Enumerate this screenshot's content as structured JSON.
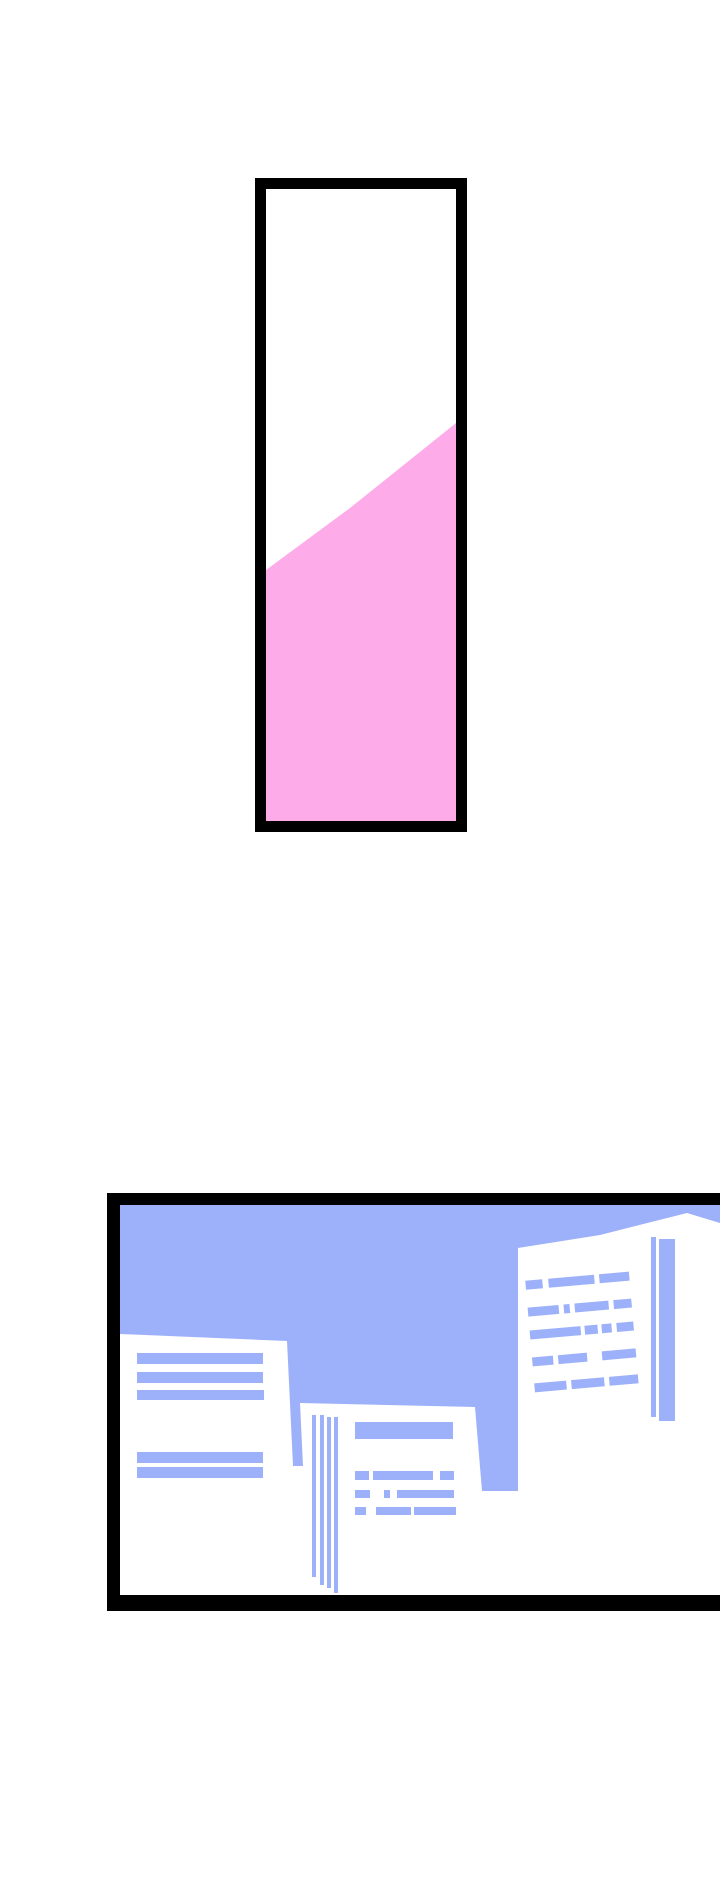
{
  "page": {
    "kind": "comic-strip-page",
    "width": 720,
    "height": 1890,
    "background": "#ffffff"
  },
  "colors": {
    "panel_border": "#000000",
    "panel_interior": "#ffffff",
    "pink_fill": "#fdace9",
    "sky_blue": "#9db1fa"
  },
  "panels": [
    {
      "name": "tube-panel",
      "description": "tall framed panel, white interior with diagonal pink fill rising to the right",
      "x": 255,
      "y": 178,
      "w": 213,
      "h": 654,
      "shapes": [
        {
          "name": "panel-frame",
          "type": "rect",
          "x": 255,
          "y": 178,
          "w": 212,
          "h": 654,
          "fill": "#000000"
        },
        {
          "name": "panel-interior",
          "type": "rect",
          "x": 266,
          "y": 189,
          "w": 190,
          "h": 632,
          "fill": "#ffffff"
        },
        {
          "name": "pink-liquid-fill",
          "type": "polygon",
          "fill": "#fdace9",
          "points": "266,570 350,508 456,423 456,821 266,821"
        }
      ]
    },
    {
      "name": "city-panel",
      "description": "framed cityscape illustration cut off at right page edge: blue sky, white buildings with blue window stripes",
      "x": 107,
      "y": 1193,
      "w": 613,
      "h": 418,
      "shapes": [
        {
          "name": "panel-frame",
          "type": "rect",
          "x": 107,
          "y": 1193,
          "w": 660,
          "h": 418,
          "fill": "#000000"
        },
        {
          "name": "panel-interior",
          "type": "rect",
          "x": 120,
          "y": 1205,
          "w": 640,
          "h": 390,
          "fill": "#ffffff"
        },
        {
          "name": "sky",
          "type": "polygon",
          "fill": "#9db1fa",
          "points": "120,1205 760,1205 760,1232 740,1229 687,1213 600,1235 518,1248 518,1491 482,1491 475,1407 300,1403 303,1466 293,1466 287,1341 120,1334"
        },
        {
          "name": "left-building-window-stripe",
          "type": "rect",
          "x": 137,
          "y": 1353,
          "w": 126,
          "h": 11,
          "fill": "#9db1fa"
        },
        {
          "name": "left-building-window-stripe",
          "type": "rect",
          "x": 137,
          "y": 1372,
          "w": 126,
          "h": 11,
          "fill": "#9db1fa"
        },
        {
          "name": "left-building-window-stripe",
          "type": "rect",
          "x": 137,
          "y": 1390,
          "w": 127,
          "h": 10,
          "fill": "#9db1fa"
        },
        {
          "name": "left-building-window-stripe",
          "type": "rect",
          "x": 137,
          "y": 1452,
          "w": 126,
          "h": 11,
          "fill": "#9db1fa"
        },
        {
          "name": "left-building-window-stripe",
          "type": "rect",
          "x": 137,
          "y": 1467,
          "w": 126,
          "h": 11,
          "fill": "#9db1fa"
        },
        {
          "name": "middle-building-edge-line",
          "type": "rect",
          "x": 312,
          "y": 1415,
          "w": 4,
          "h": 162,
          "fill": "#9db1fa"
        },
        {
          "name": "middle-building-edge-line",
          "type": "rect",
          "x": 320,
          "y": 1415,
          "w": 4,
          "h": 170,
          "fill": "#9db1fa"
        },
        {
          "name": "middle-building-edge-line",
          "type": "rect",
          "x": 327,
          "y": 1417,
          "w": 4,
          "h": 171,
          "fill": "#9db1fa"
        },
        {
          "name": "middle-building-edge-line",
          "type": "rect",
          "x": 334,
          "y": 1417,
          "w": 4,
          "h": 176,
          "fill": "#9db1fa"
        },
        {
          "name": "middle-building-sign",
          "type": "rect",
          "x": 355,
          "y": 1422,
          "w": 98,
          "h": 17,
          "fill": "#9db1fa"
        },
        {
          "name": "middle-building-text-dash",
          "type": "rect",
          "x": 355,
          "y": 1471,
          "w": 14,
          "h": 9,
          "fill": "#9db1fa"
        },
        {
          "name": "middle-building-text-dash",
          "type": "rect",
          "x": 373,
          "y": 1471,
          "w": 60,
          "h": 9,
          "fill": "#9db1fa"
        },
        {
          "name": "middle-building-text-dash",
          "type": "rect",
          "x": 440,
          "y": 1471,
          "w": 14,
          "h": 9,
          "fill": "#9db1fa"
        },
        {
          "name": "middle-building-text-dash",
          "type": "rect",
          "x": 355,
          "y": 1490,
          "w": 15,
          "h": 8,
          "fill": "#9db1fa"
        },
        {
          "name": "middle-building-text-dash",
          "type": "rect",
          "x": 384,
          "y": 1490,
          "w": 6,
          "h": 8,
          "fill": "#9db1fa"
        },
        {
          "name": "middle-building-text-dash",
          "type": "rect",
          "x": 397,
          "y": 1490,
          "w": 57,
          "h": 8,
          "fill": "#9db1fa"
        },
        {
          "name": "middle-building-text-dash",
          "type": "rect",
          "x": 355,
          "y": 1507,
          "w": 11,
          "h": 8,
          "fill": "#9db1fa"
        },
        {
          "name": "middle-building-text-dash",
          "type": "rect",
          "x": 376,
          "y": 1507,
          "w": 35,
          "h": 8,
          "fill": "#9db1fa"
        },
        {
          "name": "middle-building-text-dash",
          "type": "rect",
          "x": 414,
          "y": 1507,
          "w": 42,
          "h": 8,
          "fill": "#9db1fa"
        },
        {
          "name": "right-building-windows",
          "type": "group",
          "transform": "rotate(-5 582 1333)",
          "shapes": [
            {
              "name": "right-building-window-dash",
              "type": "rect",
              "x": 530,
              "y": 1276,
              "w": 17,
              "h": 9,
              "fill": "#9db1fa"
            },
            {
              "name": "right-building-window-dash",
              "type": "rect",
              "x": 553,
              "y": 1276,
              "w": 46,
              "h": 9,
              "fill": "#9db1fa"
            },
            {
              "name": "right-building-window-dash",
              "type": "rect",
              "x": 604,
              "y": 1276,
              "w": 30,
              "h": 9,
              "fill": "#9db1fa"
            },
            {
              "name": "right-building-window-dash",
              "type": "rect",
              "x": 530,
              "y": 1303,
              "w": 31,
              "h": 9,
              "fill": "#9db1fa"
            },
            {
              "name": "right-building-window-dash",
              "type": "rect",
              "x": 566,
              "y": 1303,
              "w": 6,
              "h": 9,
              "fill": "#9db1fa"
            },
            {
              "name": "right-building-window-dash",
              "type": "rect",
              "x": 577,
              "y": 1303,
              "w": 34,
              "h": 9,
              "fill": "#9db1fa"
            },
            {
              "name": "right-building-window-dash",
              "type": "rect",
              "x": 616,
              "y": 1303,
              "w": 18,
              "h": 9,
              "fill": "#9db1fa"
            },
            {
              "name": "right-building-window-dash",
              "type": "rect",
              "x": 530,
              "y": 1326,
              "w": 51,
              "h": 9,
              "fill": "#9db1fa"
            },
            {
              "name": "right-building-window-dash",
              "type": "rect",
              "x": 585,
              "y": 1326,
              "w": 13,
              "h": 9,
              "fill": "#9db1fa"
            },
            {
              "name": "right-building-window-dash",
              "type": "rect",
              "x": 602,
              "y": 1326,
              "w": 10,
              "h": 9,
              "fill": "#9db1fa"
            },
            {
              "name": "right-building-window-dash",
              "type": "rect",
              "x": 617,
              "y": 1326,
              "w": 17,
              "h": 9,
              "fill": "#9db1fa"
            },
            {
              "name": "right-building-window-dash",
              "type": "rect",
              "x": 530,
              "y": 1353,
              "w": 21,
              "h": 9,
              "fill": "#9db1fa"
            },
            {
              "name": "right-building-window-dash",
              "type": "rect",
              "x": 556,
              "y": 1353,
              "w": 29,
              "h": 9,
              "fill": "#9db1fa"
            },
            {
              "name": "right-building-window-dash",
              "type": "rect",
              "x": 600,
              "y": 1353,
              "w": 34,
              "h": 9,
              "fill": "#9db1fa"
            },
            {
              "name": "right-building-window-dash",
              "type": "rect",
              "x": 530,
              "y": 1379,
              "w": 32,
              "h": 9,
              "fill": "#9db1fa"
            },
            {
              "name": "right-building-window-dash",
              "type": "rect",
              "x": 567,
              "y": 1379,
              "w": 33,
              "h": 9,
              "fill": "#9db1fa"
            },
            {
              "name": "right-building-window-dash",
              "type": "rect",
              "x": 605,
              "y": 1379,
              "w": 29,
              "h": 9,
              "fill": "#9db1fa"
            }
          ]
        },
        {
          "name": "right-building-corner-stripe",
          "type": "rect",
          "x": 651,
          "y": 1237,
          "w": 5,
          "h": 180,
          "fill": "#9db1fa"
        },
        {
          "name": "right-building-corner-stripe",
          "type": "rect",
          "x": 659,
          "y": 1239,
          "w": 16,
          "h": 182,
          "fill": "#9db1fa"
        }
      ]
    }
  ]
}
